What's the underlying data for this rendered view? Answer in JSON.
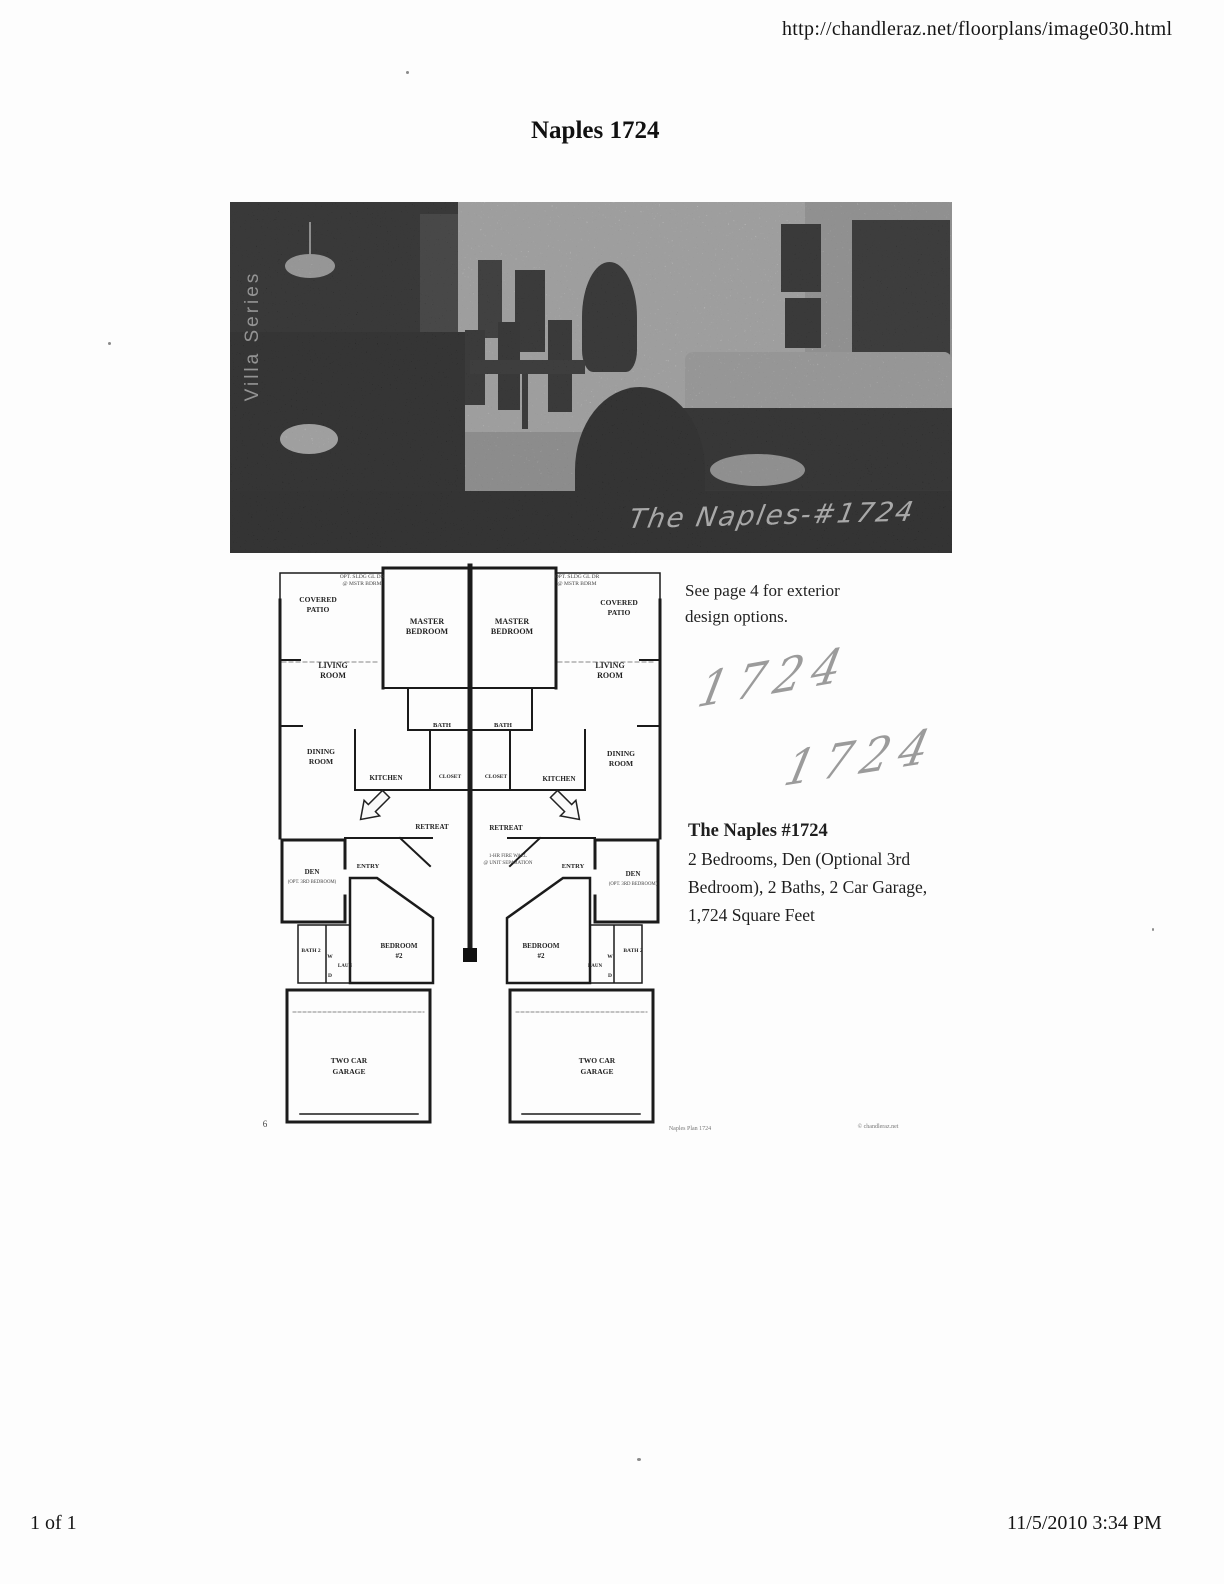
{
  "header": {
    "url": "http://chandleraz.net/floorplans/image030.html"
  },
  "title": "Naples 1724",
  "photo": {
    "series_label": "Villa Series",
    "caption": "The Naples-#1724"
  },
  "floorplan": {
    "opt_note_line1": "OPT. SLDG GL DR",
    "opt_note_line2": "@ MSTR BDRM",
    "covered_patio_line1": "COVERED",
    "covered_patio_line2": "PATIO",
    "master_line1": "MASTER",
    "master_line2": "BEDROOM",
    "living_line1": "LIVING",
    "living_line2": "ROOM",
    "dining_line1": "DINING",
    "dining_line2": "ROOM",
    "bath": "BATH",
    "closet": "CLOSET",
    "kitchen": "KITCHEN",
    "retreat": "RETREAT",
    "entry": "ENTRY",
    "den": "DEN",
    "den_sub": "(OPT. 3RD BEDROOM)",
    "bath2": "BATH 2",
    "washer": "W",
    "laundry": "LAUN",
    "dryer": "D",
    "bedroom2_line1": "BEDROOM",
    "bedroom2_line2": "#2",
    "garage_line1": "TWO CAR",
    "garage_line2": "GARAGE",
    "center_note_line1": "1-HR FIRE WALL",
    "center_note_line2": "@ UNIT SEPARATION",
    "page_number": "6",
    "plan_footer_left": "Naples Plan 1724",
    "plan_footer_right": "© chandleraz.net"
  },
  "sidebar": {
    "exterior_note_line1": "See page 4 for exterior",
    "exterior_note_line2": "design options.",
    "handwritten_a": "1724",
    "handwritten_b": "1724",
    "plan_title": "The Naples #1724",
    "desc_line1": "2 Bedrooms, Den (Optional 3rd",
    "desc_line2": "Bedroom), 2 Baths, 2 Car Garage,",
    "desc_line3": "1,724 Square Feet"
  },
  "footer": {
    "page_indicator": "1 of 1",
    "timestamp": "11/5/2010 3:34 PM"
  }
}
